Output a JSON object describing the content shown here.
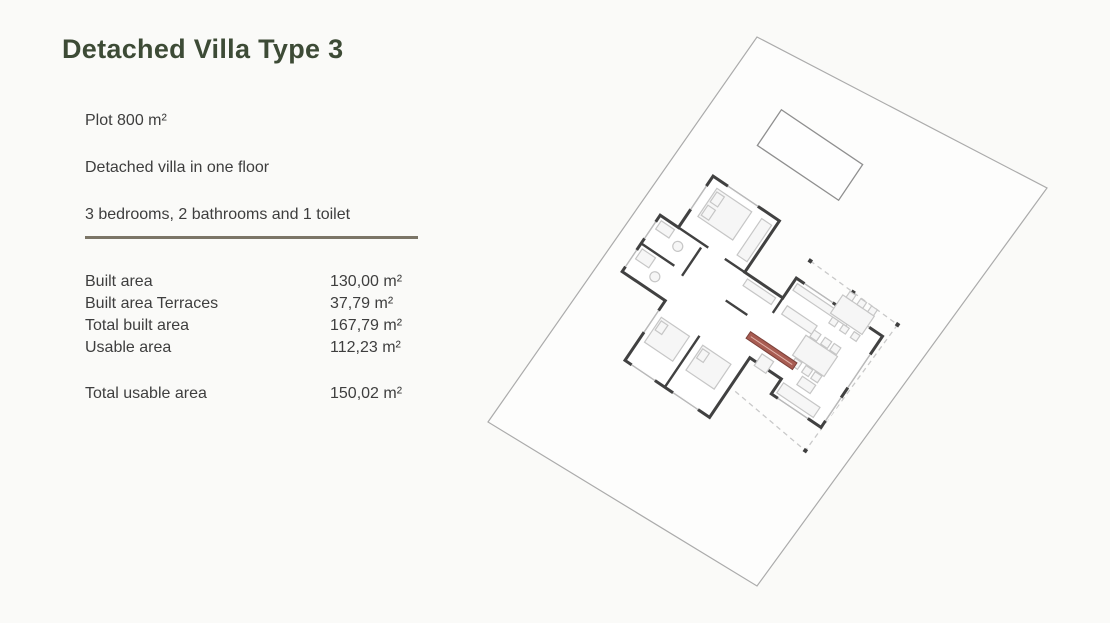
{
  "slide": {
    "title": "Detached Villa Type 3",
    "intro_lines": [
      "Plot 800 m²",
      "Detached villa in one floor",
      "3 bedrooms, 2 bathrooms and 1 toilet"
    ],
    "area_table": {
      "rows": [
        {
          "label": "Built area",
          "value": "130,00 m²"
        },
        {
          "label": "Built area Terraces",
          "value": "37,79 m²"
        },
        {
          "label": "Total built area",
          "value": "167,79 m²"
        },
        {
          "label": "Usable area",
          "value": "112,23 m²"
        }
      ],
      "total": {
        "label": "Total usable area",
        "value": "150,02 m²"
      }
    },
    "colors": {
      "title_green": "#3d4b36",
      "divider_olive": "#7b7567",
      "body_text": "#3e3e3e",
      "plan_wall": "#414141",
      "plan_accent": "#a85c52",
      "plot_line": "#ababab"
    }
  }
}
